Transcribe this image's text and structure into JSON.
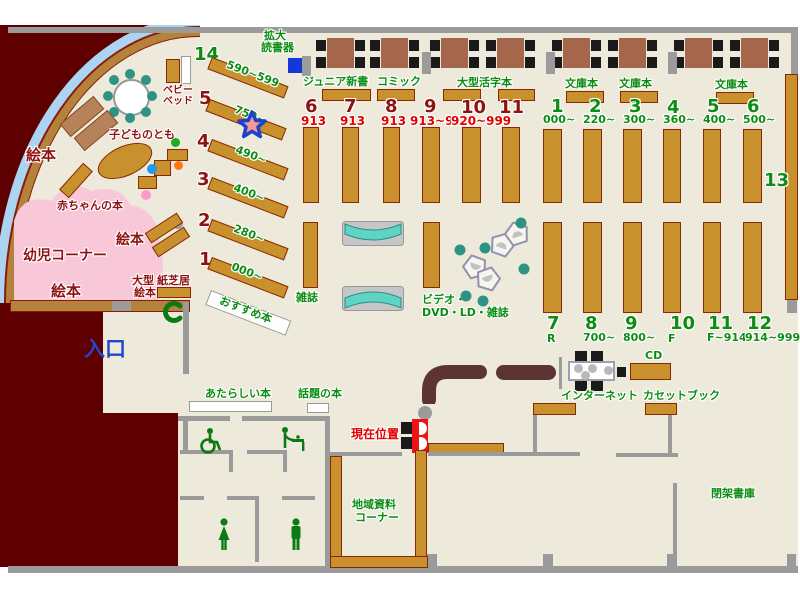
{
  "colors": {
    "floor": "#edeadb",
    "exterior": "#5e0000",
    "wall": "#9b9b9b",
    "shelf": "#c8912e",
    "shelf_border": "#8b2804",
    "window": "#abd3f2",
    "pink": "#f8c8d8",
    "table": "#a5674b",
    "teal_seat": "#2e9383",
    "teal_rack": "#5ed3c6",
    "green": "#0d8c12",
    "dark_red": "#8e1212",
    "red": "#e30000",
    "entrance_blue": "#2244cc",
    "marker_red": "#ee1414",
    "star_outline_blue": "#1c41cf",
    "magnifier_blue": "#1637d8"
  },
  "reading": {
    "magnifier_line1": "拡大",
    "magnifier_line2": "読書器",
    "sections": [
      "ジュニア新書",
      "コミック",
      "大型活字本",
      "文庫本",
      "文庫本",
      "文庫本"
    ]
  },
  "left": {
    "shelves": [
      {
        "num": "14",
        "range": "590~599"
      },
      {
        "num": "5",
        "range": "750~"
      },
      {
        "num": "4",
        "range": "490~"
      },
      {
        "num": "3",
        "range": "400~"
      },
      {
        "num": "2",
        "range": "280~"
      },
      {
        "num": "1",
        "range": "000~"
      }
    ],
    "recommended": "おすすめ本"
  },
  "kids": {
    "corner": "幼児コーナー",
    "picture_books": "絵本",
    "baby_books": "赤ちゃんの本",
    "kodomo_no_tomo": "子どものとも",
    "baby_bed_line1": "ベビー",
    "baby_bed_line2": "ベッド",
    "large_picture_line1": "大型",
    "large_picture_line2": "絵本",
    "kamishibai": "紙芝居"
  },
  "center": {
    "shelves": [
      {
        "num": "6",
        "range": "913"
      },
      {
        "num": "7",
        "range": "913"
      },
      {
        "num": "8",
        "range": "913"
      },
      {
        "num": "9",
        "range": "913~919"
      },
      {
        "num": "10",
        "range": "920~999"
      },
      {
        "num": "11",
        "range": ""
      }
    ],
    "magazines": "雑誌",
    "av_line1": "ビデオ・",
    "av_line2": "DVD・LD・雑誌"
  },
  "right": {
    "top": [
      {
        "num": "1",
        "range": "000~"
      },
      {
        "num": "2",
        "range": "220~"
      },
      {
        "num": "3",
        "range": "300~"
      },
      {
        "num": "4",
        "range": "360~"
      },
      {
        "num": "5",
        "range": "400~"
      },
      {
        "num": "6",
        "range": "500~"
      }
    ],
    "bottom": [
      {
        "num": "7",
        "range": "R"
      },
      {
        "num": "8",
        "range": "700~"
      },
      {
        "num": "9",
        "range": "800~"
      },
      {
        "num": "10",
        "range": "F"
      },
      {
        "num": "11",
        "range": "F~914"
      },
      {
        "num": "12",
        "range": "914~999"
      }
    ],
    "wall_shelf": "13"
  },
  "services": {
    "cd": "CD",
    "internet": "インターネット",
    "cassette": "カセットブック",
    "current_location": "現在位置"
  },
  "south": {
    "new_books": "あたらしい本",
    "topic_books": "話題の本",
    "local_line1": "地域資料",
    "local_line2": "コーナー",
    "closed_stacks": "閉架書庫",
    "entrance": "入口"
  }
}
